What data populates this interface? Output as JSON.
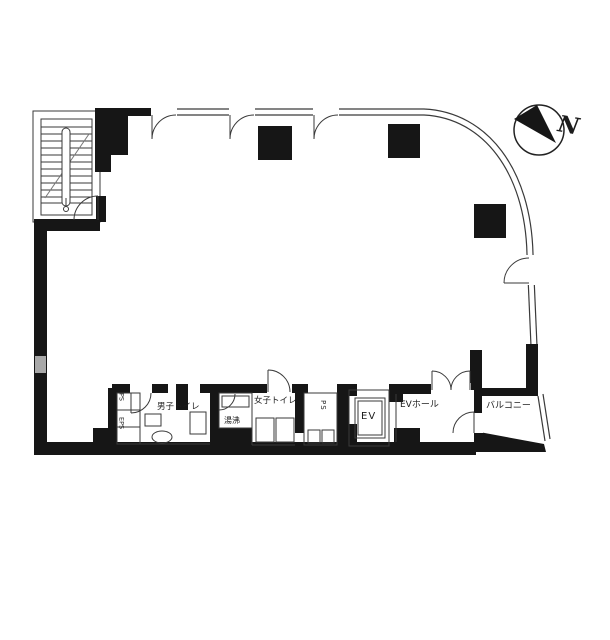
{
  "title": "建物平面図",
  "compass": {
    "label": "N"
  },
  "rooms": {
    "mens_toilet": "男子トイレ",
    "kitchenette": "湯沸",
    "womens_toilet": "女子トイレ",
    "pipe_space_center": "PS",
    "pipe_space_left_top": "PS",
    "pipe_space_left_bottom": "EPS",
    "elevator": "EV",
    "elevator_hall": "EVホール",
    "balcony": "バルコニー"
  },
  "colors": {
    "wall": "#161616",
    "line": "#3a3a3a",
    "background": "#ffffff"
  }
}
